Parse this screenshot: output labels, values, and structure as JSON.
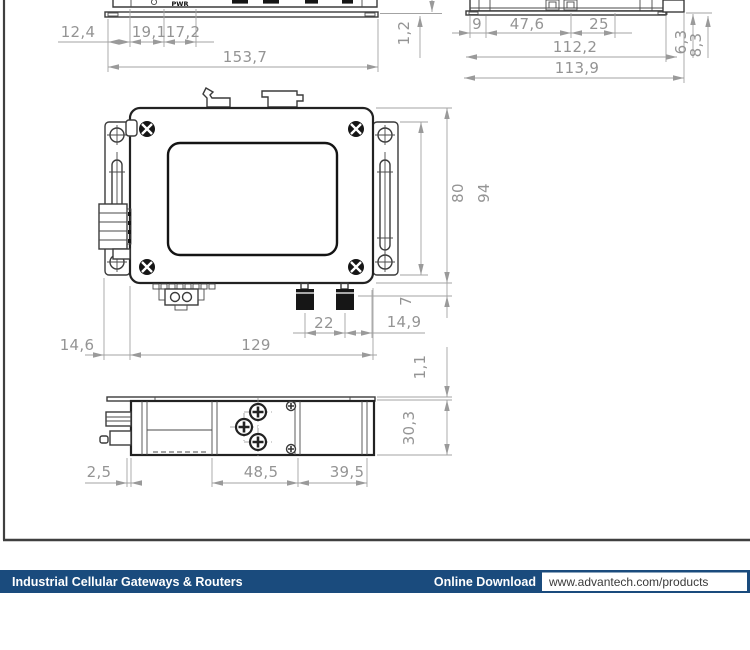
{
  "labels": {
    "pwr": "PWR"
  },
  "dims": {
    "front": {
      "a": "12,4",
      "b": "19,1",
      "c": "17,2",
      "total": "153,7",
      "plate": "1,2"
    },
    "side": {
      "a": "9",
      "b": "47,6",
      "c": "25",
      "inner": "112,2",
      "outer": "113,9",
      "v1": "6,3",
      "v2": "8,3"
    },
    "top": {
      "bracket": "80",
      "total": "94",
      "ant": "7",
      "spacing": "22",
      "right": "14,9",
      "left": "14,6",
      "body": "129"
    },
    "bottom": {
      "a": "2,5",
      "b": "48,5",
      "c": "39,5",
      "h": "30,3",
      "plate": "1,1"
    }
  },
  "footer": {
    "left_label": "Industrial Cellular Gateways & Routers",
    "download_label": "Online Download",
    "url": "www.advantech.com/products"
  },
  "colors": {
    "footer_bar": "#1a4b7d",
    "device_line": "#3b3b3b",
    "dimension_line": "#9a9a9a",
    "dimension_text": "#949494",
    "url_text": "#3a3a3a"
  }
}
